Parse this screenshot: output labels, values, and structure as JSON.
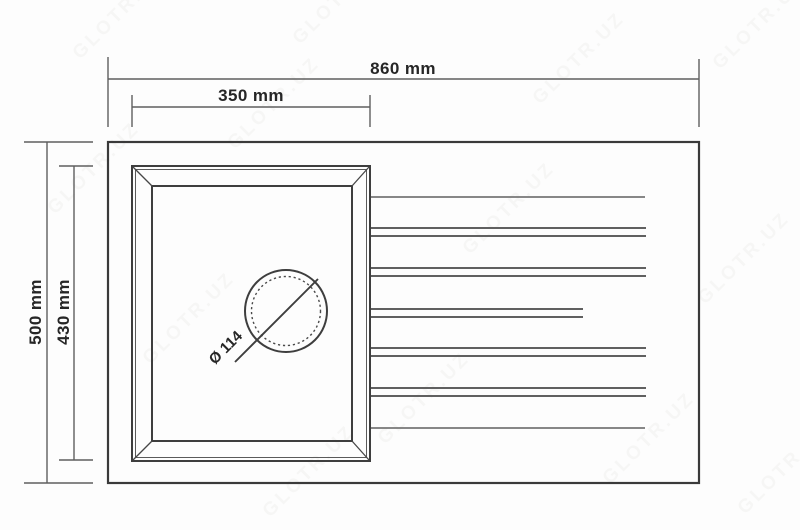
{
  "diagram": {
    "type": "technical-drawing",
    "subject": "kitchen sink top view with single bowl, drain hole and drainboard grooves",
    "dimension_labels": {
      "overall_width": "860 mm",
      "bowl_width": "350 mm",
      "overall_depth": "500 mm",
      "bowl_depth": "430 mm",
      "drain_diameter": "Ø 114"
    },
    "dimension_values_mm": {
      "overall_width": 860,
      "bowl_width": 350,
      "overall_depth": 500,
      "bowl_depth": 430,
      "drain_diameter": 114
    },
    "features": {
      "drainboard_groove_rows": 7
    },
    "colors": {
      "line": "#3e3e3e",
      "dimension_line": "#5f5f5f",
      "text": "#262626",
      "background": "#fdfdfd",
      "watermark": "#8b8677"
    }
  },
  "watermark": {
    "text": "GLOTR.UZ"
  }
}
